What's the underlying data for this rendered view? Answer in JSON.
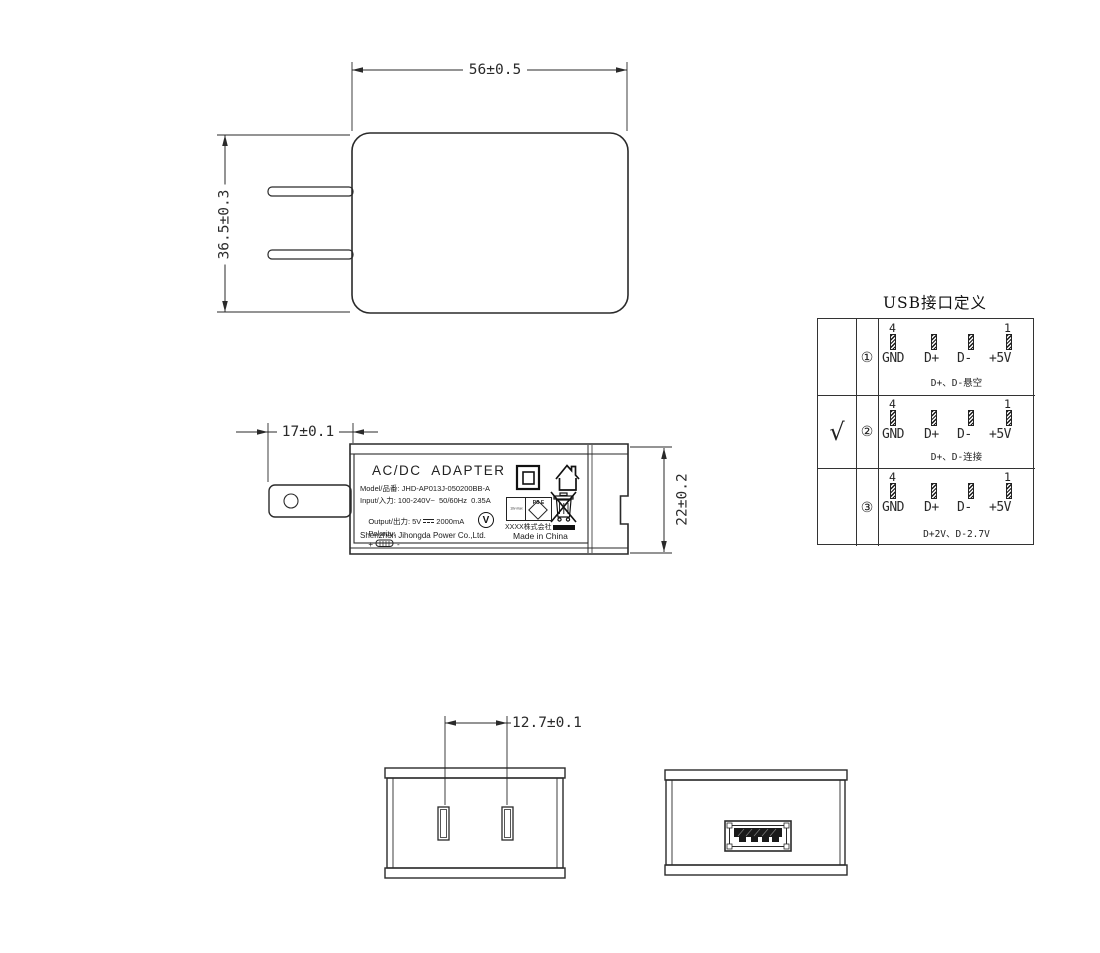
{
  "dimensions": {
    "front_width": "56±0.5",
    "front_height": "36.5±0.3",
    "plug_length": "17±0.1",
    "body_thickness": "22±0.2",
    "pin_spacing": "12.7±0.1"
  },
  "label": {
    "title": "AC/DC  ADAPTER",
    "model": "Model/品番: JHD-AP013J-050200BB-A",
    "input": "Input/入力: 100-240V~  50/60Hz  0.35A",
    "output_prefix": "Output/出力: 5V",
    "output_suffix": "2000mA",
    "polarity_label": "Polarity:",
    "polarity_plus": "+",
    "polarity_minus": "-",
    "company": "Shenzhen Jihongda Power Co.,Ltd.",
    "maker": "XXXX株式会社",
    "made_in": "Made in China",
    "efficiency_mark": "V",
    "pse_side_text": "10v max",
    "pse_diamond_text": "PS E"
  },
  "usb_table": {
    "title": "USB接口定义",
    "check_mark": "√",
    "pin_first": "4",
    "pin_last": "1",
    "pin_labels": [
      "GND",
      "D+",
      "D-",
      "+5V"
    ],
    "rows": [
      {
        "num": "①",
        "caption": "D+、D-悬空"
      },
      {
        "num": "②",
        "caption": "D+、D-连接"
      },
      {
        "num": "③",
        "caption": "D+2V、D-2.7V"
      }
    ]
  }
}
